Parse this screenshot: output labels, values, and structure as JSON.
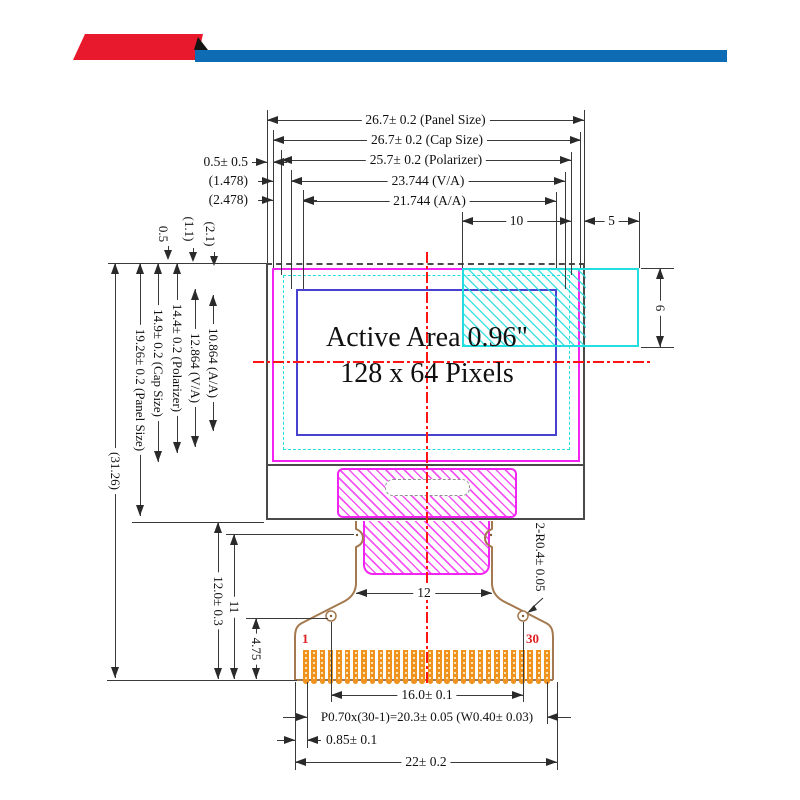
{
  "banner": {
    "red_color": "#e8192c",
    "blue_color": "#0e6cb4"
  },
  "display_area": {
    "line1": "Active Area 0.96\"",
    "line2": "128 x 64 Pixels"
  },
  "dimensions": {
    "top": [
      "26.7± 0.2 (Panel Size)",
      "26.7± 0.2 (Cap Size)",
      "25.7± 0.2 (Polarizer)",
      "23.744 (V/A)",
      "21.744 (A/A)"
    ],
    "top_right": [
      "10",
      "5"
    ],
    "left_offsets": [
      "0.5± 0.5",
      "(1.478)",
      "(2.478)"
    ],
    "top_offsets": [
      "0.5",
      "(1.1)",
      "(2.1)"
    ],
    "left_vertical": [
      "(31.26)",
      "19.26± 0.2 (Panel Size)",
      "14.9± 0.2 (Cap Size)",
      "14.4± 0.2 (Polarizer)",
      "12.864 (V/A)",
      "10.864 (A/A)"
    ],
    "lower_left_vertical": [
      "12.0± 0.3",
      "11",
      "4.75"
    ],
    "right_vertical": [
      "6"
    ],
    "corner_radius": "2-R0.4± 0.05",
    "fpc_width": "12",
    "bottom": [
      "16.0± 0.1",
      "P0.70x(30-1)=20.3± 0.05 (W0.40± 0.03)",
      "0.85± 0.1",
      "22± 0.2"
    ]
  },
  "connector": {
    "first_pin": "1",
    "last_pin": "30",
    "pin_count": 30
  },
  "colors": {
    "outline": "#3a3a3a",
    "panel": "#4a4a4a",
    "magenta": "#f324f3",
    "cyan": "#23dede",
    "viewing_area_blue": "#4941cf",
    "centerline_red": "#ff1414",
    "fpc_brown": "#a5794f",
    "pin_orange": "#f0921e",
    "pin_label_red": "#e02020"
  }
}
